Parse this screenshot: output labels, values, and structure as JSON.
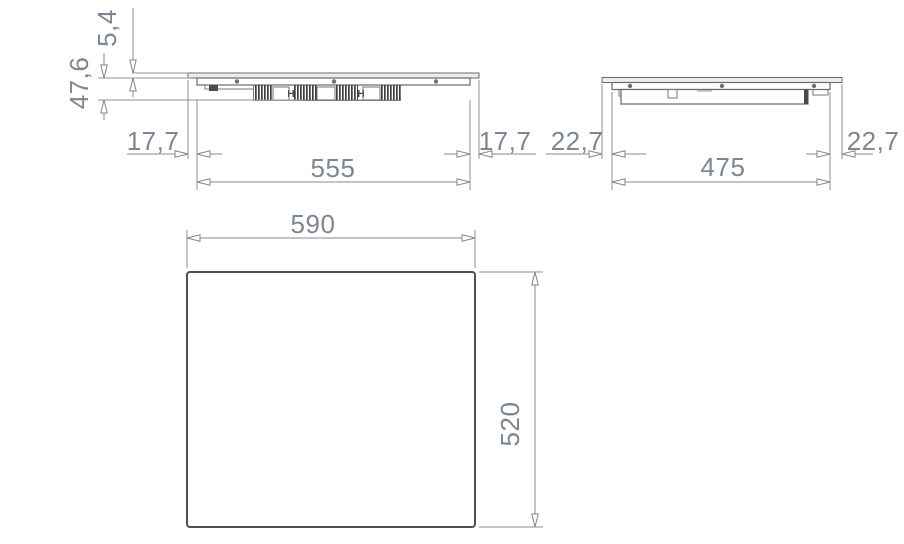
{
  "drawing_type": "cooktop installation dimensions (mm)",
  "views": {
    "side_front": {
      "glass_height": "5,4",
      "body_depth": "47,6",
      "left_overhang": "17,7",
      "body_width": "555",
      "right_overhang": "17,7",
      "clamp_mark_left": "H",
      "clamp_mark_right": "H"
    },
    "side_profile": {
      "left_overhang": "22,7",
      "body_width": "475",
      "right_overhang": "22,7"
    },
    "plan": {
      "width": "590",
      "depth": "520"
    }
  },
  "colors": {
    "dimension_text": "#7c8694",
    "dimension_line": "#8a8a8a",
    "outline": "#696969",
    "plan_outline": "#4f4f4f",
    "fin_dark": "#3e3e3e",
    "background": "#ffffff"
  }
}
